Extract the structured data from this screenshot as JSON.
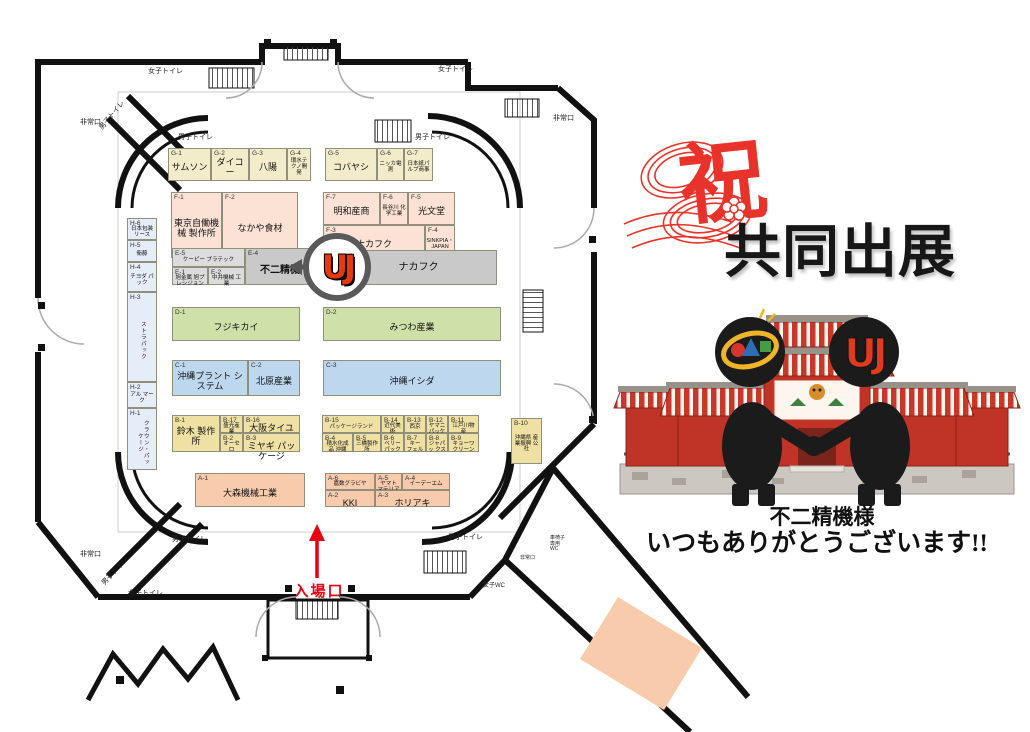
{
  "banner": {
    "celebration": "祝",
    "title": "共同出展",
    "recipient": "不二精機様",
    "message": "いつもありがとうございます!!"
  },
  "logo": {
    "letters": "UJ"
  },
  "floorplan": {
    "entrance_label": "入場口",
    "office_label": "事務局",
    "booths": [
      {
        "id": "G-1",
        "name": "サムソン",
        "group": "g",
        "x": 168,
        "y": 148,
        "w": 43,
        "h": 33
      },
      {
        "id": "G-2",
        "name": "ダイコー",
        "group": "g",
        "x": 211,
        "y": 148,
        "w": 38,
        "h": 33
      },
      {
        "id": "G-3",
        "name": "八陽",
        "group": "g",
        "x": 249,
        "y": 148,
        "w": 38,
        "h": 33
      },
      {
        "id": "G-4",
        "name": "環水テクノ開発",
        "group": "g",
        "x": 287,
        "y": 148,
        "w": 24,
        "h": 33,
        "small": true
      },
      {
        "id": "G-5",
        "name": "コバヤシ",
        "group": "g",
        "x": 325,
        "y": 148,
        "w": 52,
        "h": 33
      },
      {
        "id": "G-6",
        "name": "ニッカ電測",
        "group": "g",
        "x": 377,
        "y": 148,
        "w": 27,
        "h": 33,
        "small": true
      },
      {
        "id": "G-7",
        "name": "日本紙パルプ商事",
        "group": "g",
        "x": 404,
        "y": 148,
        "w": 29,
        "h": 33,
        "small": true
      },
      {
        "id": "F-1",
        "name": "東京自働機械 製作所",
        "group": "f",
        "x": 171,
        "y": 192,
        "w": 51,
        "h": 66
      },
      {
        "id": "F-2",
        "name": "なかや食材",
        "group": "f",
        "x": 222,
        "y": 192,
        "w": 76,
        "h": 66
      },
      {
        "id": "F-7",
        "name": "明和産商",
        "group": "f",
        "x": 323,
        "y": 192,
        "w": 57,
        "h": 33
      },
      {
        "id": "F-6",
        "name": "長谷川 化学工業",
        "group": "f",
        "x": 380,
        "y": 192,
        "w": 28,
        "h": 33,
        "small": true
      },
      {
        "id": "F-5",
        "name": "光文堂",
        "group": "f",
        "x": 408,
        "y": 192,
        "w": 47,
        "h": 33
      },
      {
        "id": "F-3",
        "name": "ナカフク",
        "group": "f",
        "x": 323,
        "y": 225,
        "w": 102,
        "h": 33
      },
      {
        "id": "F-4",
        "name": "SINKPIA・ JAPAN",
        "group": "f",
        "x": 425,
        "y": 225,
        "w": 30,
        "h": 33,
        "small": true
      },
      {
        "id": "E-5",
        "name": "ケーピー プラテック",
        "group": "e",
        "x": 172,
        "y": 248,
        "w": 73,
        "h": 19,
        "small": true
      },
      {
        "id": "E-1",
        "name": "旭金属 旭プレシジョン",
        "group": "e",
        "x": 172,
        "y": 267,
        "w": 36,
        "h": 18,
        "small": true
      },
      {
        "id": "E-2",
        "name": "中井機械 工業",
        "group": "e",
        "x": 208,
        "y": 267,
        "w": 37,
        "h": 18,
        "small": true
      },
      {
        "id": "E-4",
        "name": "不二精機",
        "group": "e4",
        "x": 245,
        "y": 248,
        "w": 70,
        "h": 37
      },
      {
        "id": "",
        "name": "ナカフク",
        "group": "bar",
        "x": 340,
        "y": 250,
        "w": 157,
        "h": 35
      },
      {
        "id": "D-1",
        "name": "フジキカイ",
        "group": "d",
        "x": 172,
        "y": 307,
        "w": 128,
        "h": 34
      },
      {
        "id": "D-2",
        "name": "みつわ産業",
        "group": "d",
        "x": 323,
        "y": 307,
        "w": 178,
        "h": 34
      },
      {
        "id": "C-1",
        "name": "沖縄プラント システム",
        "group": "c",
        "x": 172,
        "y": 360,
        "w": 76,
        "h": 36
      },
      {
        "id": "C-2",
        "name": "北原産業",
        "group": "c",
        "x": 248,
        "y": 360,
        "w": 52,
        "h": 36
      },
      {
        "id": "C-3",
        "name": "沖縄イシダ",
        "group": "c",
        "x": 323,
        "y": 360,
        "w": 178,
        "h": 36
      },
      {
        "id": "B-1",
        "name": "鈴木 製作所",
        "group": "b",
        "x": 172,
        "y": 415,
        "w": 48,
        "h": 37
      },
      {
        "id": "B-17",
        "name": "盛光産業",
        "group": "b",
        "x": 220,
        "y": 415,
        "w": 23,
        "h": 18,
        "small": true
      },
      {
        "id": "B-16",
        "name": "大阪タイユー",
        "group": "b",
        "x": 243,
        "y": 415,
        "w": 57,
        "h": 18
      },
      {
        "id": "B-2",
        "name": "オーセロ",
        "group": "b",
        "x": 220,
        "y": 433,
        "w": 23,
        "h": 19,
        "small": true
      },
      {
        "id": "B-3",
        "name": "ミヤギ パッケージ",
        "group": "b",
        "x": 243,
        "y": 433,
        "w": 57,
        "h": 19
      },
      {
        "id": "B-15",
        "name": "パッケージランド",
        "group": "b",
        "x": 322,
        "y": 415,
        "w": 59,
        "h": 18,
        "small": true
      },
      {
        "id": "B-14",
        "name": "近代美術",
        "group": "b",
        "x": 381,
        "y": 415,
        "w": 23,
        "h": 18,
        "small": true
      },
      {
        "id": "B-13",
        "name": "西京",
        "group": "b",
        "x": 404,
        "y": 415,
        "w": 22,
        "h": 18,
        "small": true
      },
      {
        "id": "B-12",
        "name": "ヤマニ パッケージ",
        "group": "b",
        "x": 426,
        "y": 415,
        "w": 22,
        "h": 18,
        "small": true
      },
      {
        "id": "B-11",
        "name": "江戸川物産",
        "group": "b",
        "x": 448,
        "y": 415,
        "w": 31,
        "h": 18,
        "small": true
      },
      {
        "id": "B-4",
        "name": "積水化成品 沖縄",
        "group": "b",
        "x": 322,
        "y": 433,
        "w": 31,
        "h": 19,
        "small": true
      },
      {
        "id": "B-5",
        "name": "三橋製作所",
        "group": "b",
        "x": 353,
        "y": 433,
        "w": 28,
        "h": 19,
        "small": true
      },
      {
        "id": "B-6",
        "name": "ベリー パック",
        "group": "b",
        "x": 381,
        "y": 433,
        "w": 23,
        "h": 19,
        "small": true
      },
      {
        "id": "B-7",
        "name": "キー フェル",
        "group": "b",
        "x": 404,
        "y": 433,
        "w": 22,
        "h": 19,
        "small": true
      },
      {
        "id": "B-8",
        "name": "ジャパッ クス",
        "group": "b",
        "x": 426,
        "y": 433,
        "w": 22,
        "h": 19,
        "small": true
      },
      {
        "id": "B-9",
        "name": "キョーワ クリーン",
        "group": "b",
        "x": 448,
        "y": 433,
        "w": 31,
        "h": 19,
        "small": true
      },
      {
        "id": "B-10",
        "name": "沖縄県 産業振興 公社",
        "group": "b",
        "x": 511,
        "y": 418,
        "w": 31,
        "h": 46,
        "small": true
      },
      {
        "id": "A-1",
        "name": "大森機械工業",
        "group": "a",
        "x": 195,
        "y": 473,
        "w": 110,
        "h": 34
      },
      {
        "id": "A-6",
        "name": "嘉数グラビヤ",
        "group": "a",
        "x": 325,
        "y": 473,
        "w": 50,
        "h": 17,
        "small": true
      },
      {
        "id": "A-5",
        "name": "ヤマト マテリアル",
        "group": "a",
        "x": 375,
        "y": 473,
        "w": 27,
        "h": 17,
        "small": true
      },
      {
        "id": "A-4",
        "name": "イーデーエム",
        "group": "a",
        "x": 402,
        "y": 473,
        "w": 48,
        "h": 17,
        "small": true
      },
      {
        "id": "A-2",
        "name": "KKI",
        "group": "a",
        "x": 325,
        "y": 490,
        "w": 50,
        "h": 17
      },
      {
        "id": "A-3",
        "name": "ホリアキ",
        "group": "a",
        "x": 375,
        "y": 490,
        "w": 75,
        "h": 17
      },
      {
        "id": "H-6",
        "name": "日本包装 リース",
        "group": "h",
        "x": 127,
        "y": 218,
        "w": 30,
        "h": 22,
        "small": true
      },
      {
        "id": "H-5",
        "name": "衛藤",
        "group": "h",
        "x": 127,
        "y": 240,
        "w": 30,
        "h": 22,
        "small": true
      },
      {
        "id": "H-4",
        "name": "チヨダ パック",
        "group": "h",
        "x": 127,
        "y": 262,
        "w": 30,
        "h": 30,
        "small": true
      },
      {
        "id": "H-3",
        "name": "ストラパック",
        "group": "h",
        "x": 127,
        "y": 292,
        "w": 30,
        "h": 90,
        "small": true,
        "vertical": true
      },
      {
        "id": "H-2",
        "name": "アル マーク",
        "group": "h",
        "x": 127,
        "y": 382,
        "w": 30,
        "h": 26,
        "small": true
      },
      {
        "id": "H-1",
        "name": "クラウン・パッケージ",
        "group": "h",
        "x": 127,
        "y": 408,
        "w": 30,
        "h": 62,
        "small": true,
        "vertical": true
      }
    ],
    "labels": [
      {
        "text": "女子トイレ",
        "x": 148,
        "y": 68
      },
      {
        "text": "男子トイレ",
        "x": 95,
        "y": 112,
        "rot": -50
      },
      {
        "text": "男子トイレ",
        "x": 178,
        "y": 134
      },
      {
        "text": "非常口",
        "x": 80,
        "y": 119
      },
      {
        "text": "女子トイレ",
        "x": 438,
        "y": 66
      },
      {
        "text": "男子トイレ",
        "x": 415,
        "y": 134
      },
      {
        "text": "非常口",
        "x": 553,
        "y": 115
      },
      {
        "text": "非常口",
        "x": 80,
        "y": 551
      },
      {
        "text": "男子トイレ",
        "x": 172,
        "y": 536
      },
      {
        "text": "男子トイレ",
        "x": 98,
        "y": 568,
        "rot": -47
      },
      {
        "text": "女子トイレ",
        "x": 128,
        "y": 590
      },
      {
        "text": "男子トイレ",
        "x": 448,
        "y": 534
      },
      {
        "text": "女子WC",
        "x": 483,
        "y": 583,
        "size": 6
      },
      {
        "text": "非常口",
        "x": 520,
        "y": 556,
        "size": 5
      },
      {
        "text": "車椅子\n専用\nWC",
        "x": 550,
        "y": 536,
        "size": 5
      }
    ]
  }
}
